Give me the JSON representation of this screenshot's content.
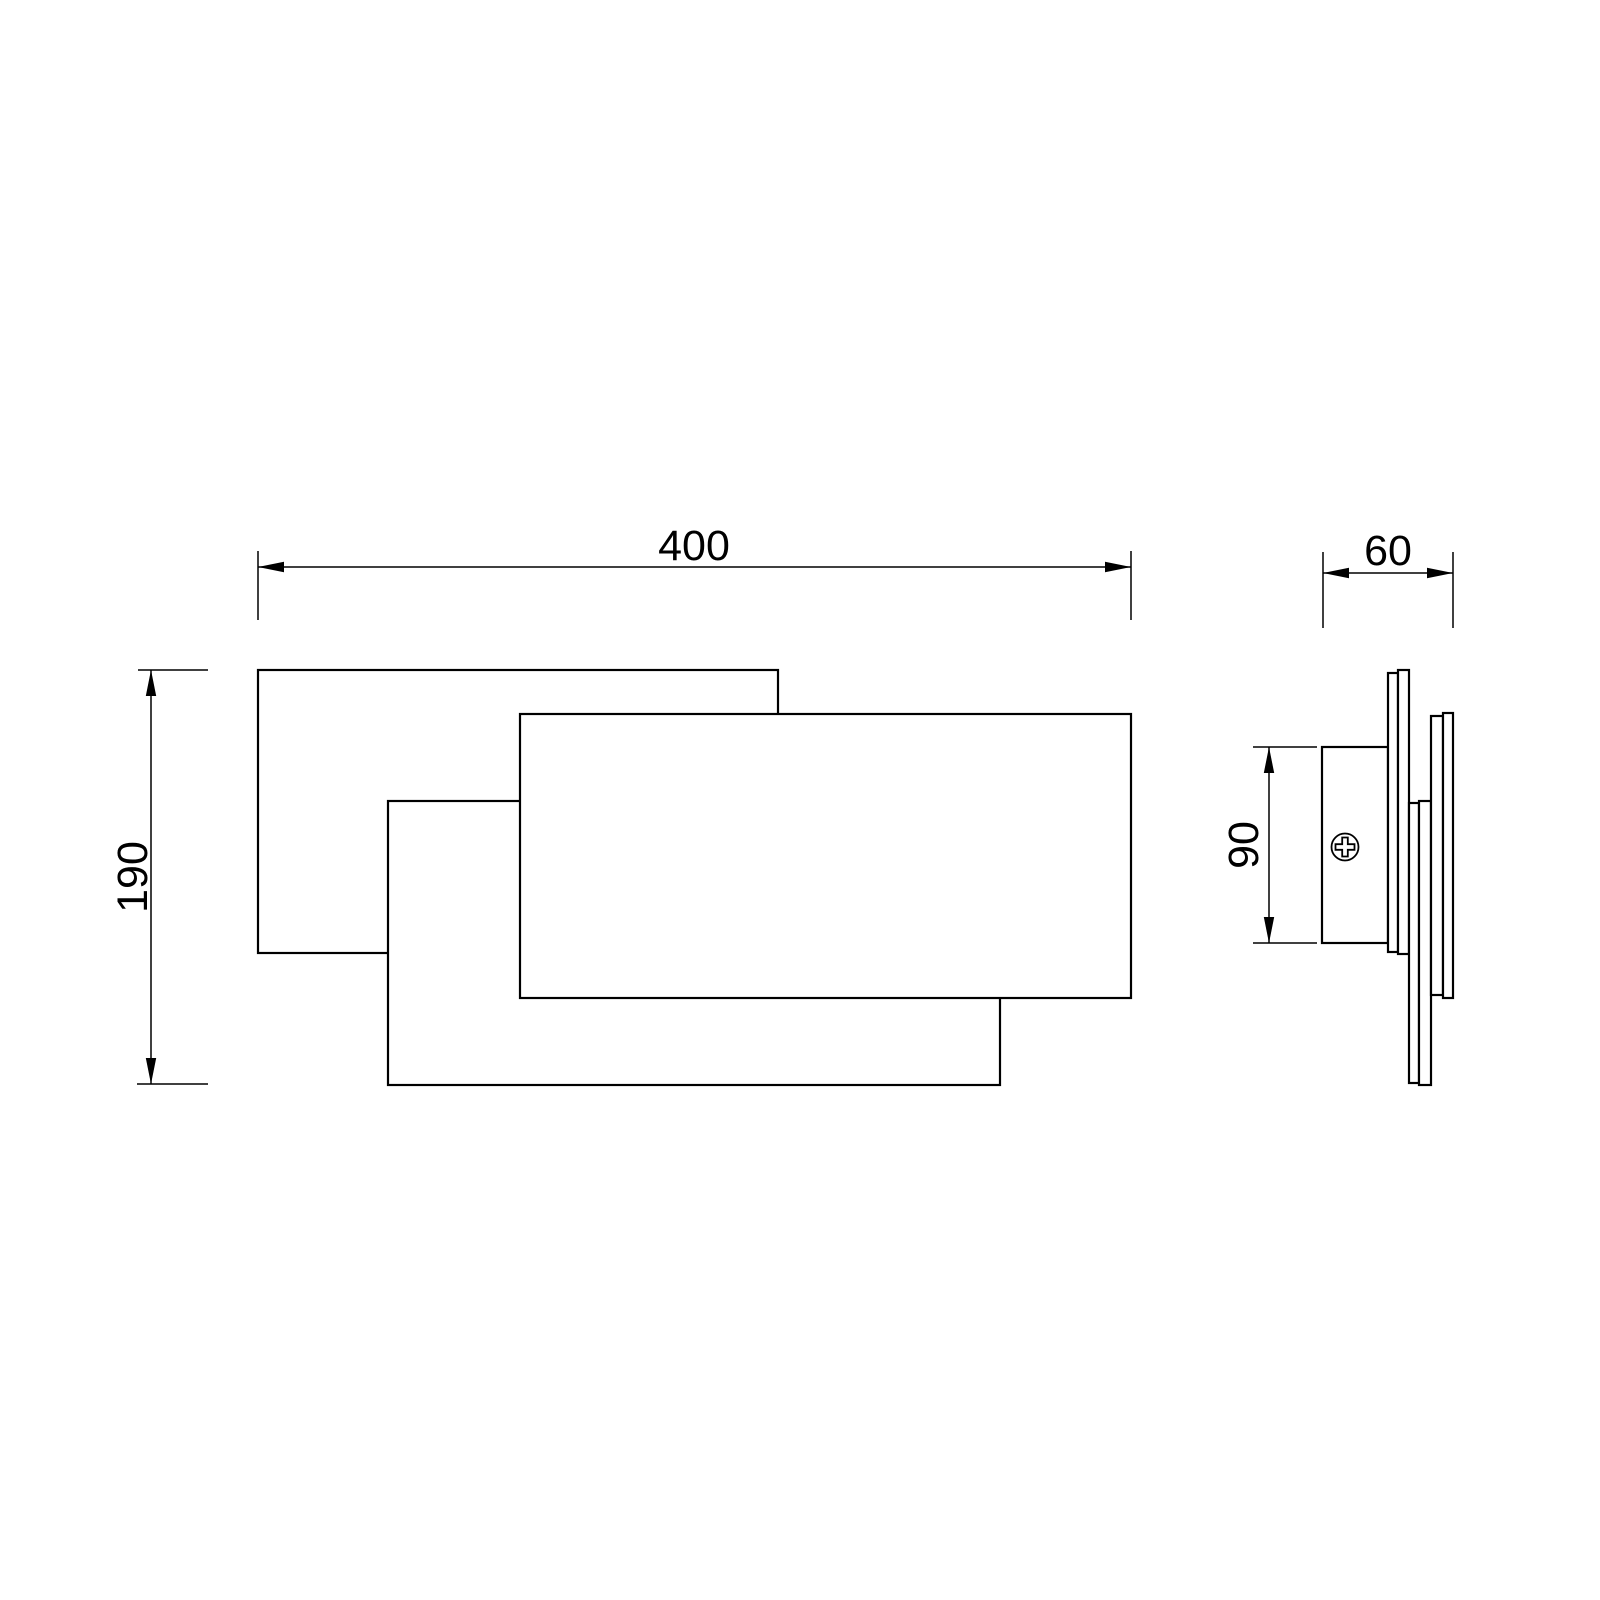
{
  "drawing": {
    "type": "technical-dimension-drawing",
    "subject": "wall lamp with three overlapping rectangular panels, front view and side view",
    "background_color": "#ffffff",
    "line_color": "#000000",
    "dimensions": {
      "front_width": "400",
      "front_height": "190",
      "side_depth": "60",
      "mount_height": "90"
    },
    "icons": {
      "screw": "phillips-screw-icon",
      "arrows": "dimension-arrow-icon"
    }
  }
}
